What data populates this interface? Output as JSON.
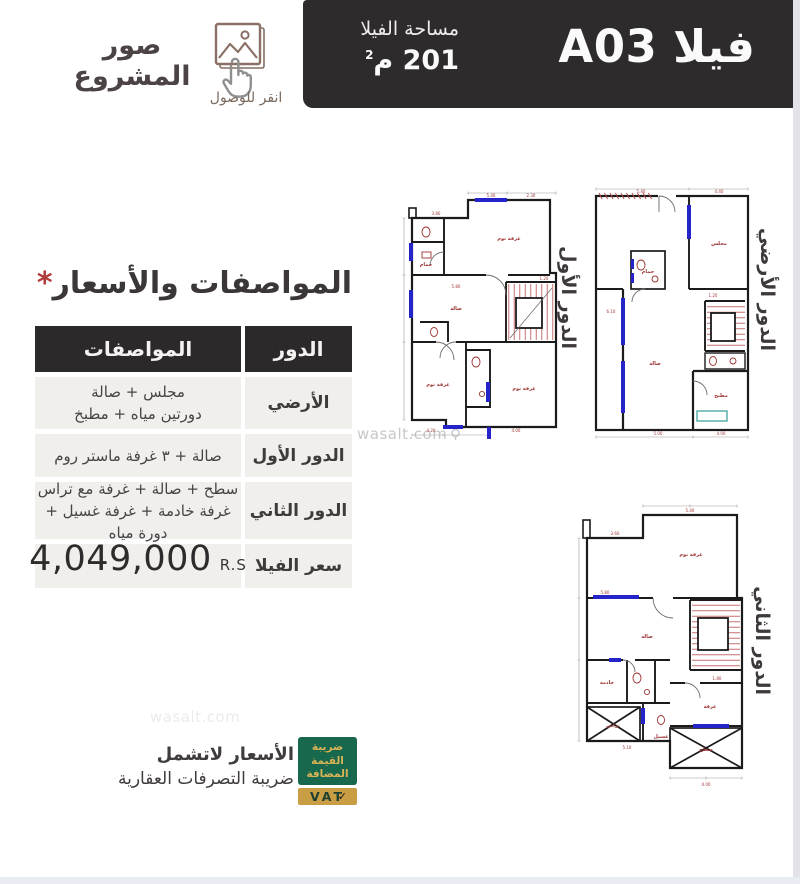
{
  "header": {
    "title_villa": "فيلا A03",
    "area_label": "مساحة الفيلا",
    "area_value": "201",
    "area_unit": "م",
    "area_sup": "2"
  },
  "photos": {
    "title": "صور المشروع",
    "caption": "انقر للوصول"
  },
  "specs": {
    "heading": "المواصفات والأسعار",
    "asterisk": "*",
    "col_floor": "الدور",
    "col_specs": "المواصفات",
    "rows": [
      {
        "floor": "الأرضي",
        "desc1": "مجلس + صالة",
        "desc2": "دورتين مياه + مطبخ"
      },
      {
        "floor": "الدور الأول",
        "desc1": "صالة + ٣ غرفة ماستر روم"
      },
      {
        "floor": "الدور الثاني",
        "desc1": "سطح + صالة + غرفة مع تراس",
        "desc2": "غرفة خادمة + غرفة غسيل + دورة مياه"
      },
      {
        "floor": "سعر الفيلا",
        "price": "4,049,000",
        "currency": "R.S"
      }
    ]
  },
  "footer": {
    "vat_badge_lines": [
      "ضريبة",
      "القيمة",
      "المضافة"
    ],
    "vat_text": "VAT",
    "vat_check": "✓",
    "note_line1": "الأسعار لاتشمل",
    "note_line2": "ضريبة التصرفات العقارية"
  },
  "watermark": "wasalt.com",
  "plans": {
    "first": {
      "label": "الدور الأول"
    },
    "ground": {
      "label": "الدور الأرضي"
    },
    "second": {
      "label": "الدور الثاني"
    },
    "rooms": {
      "bedroom": "غرفة نوم",
      "hall": "صالة",
      "majlis": "مجلس",
      "kitchen": "مطبخ",
      "bath": "حمام",
      "maid": "خادمة",
      "laundry": "غسيل",
      "terrace": "تراس",
      "roof": "سطح",
      "room": "غرفة"
    },
    "dims": [
      "5.40",
      "4.40",
      "3.80",
      "4.20",
      "1.20",
      "3.60",
      "5.00",
      "2.30",
      "6.10",
      "4.00",
      "1.80",
      "5.20",
      "3.30",
      "2.00",
      "5.80",
      "5.10",
      "4.80",
      "3.10"
    ]
  },
  "colors": {
    "banner_bg": "#2e2b2c",
    "row_bg": "#f1efec",
    "accent_red": "#b13a3a",
    "plan_blue": "#2424c8",
    "plan_red": "#9c3333",
    "vat_green": "#17684c",
    "vat_gold": "#c99d44",
    "teal": "#2f9e96"
  }
}
